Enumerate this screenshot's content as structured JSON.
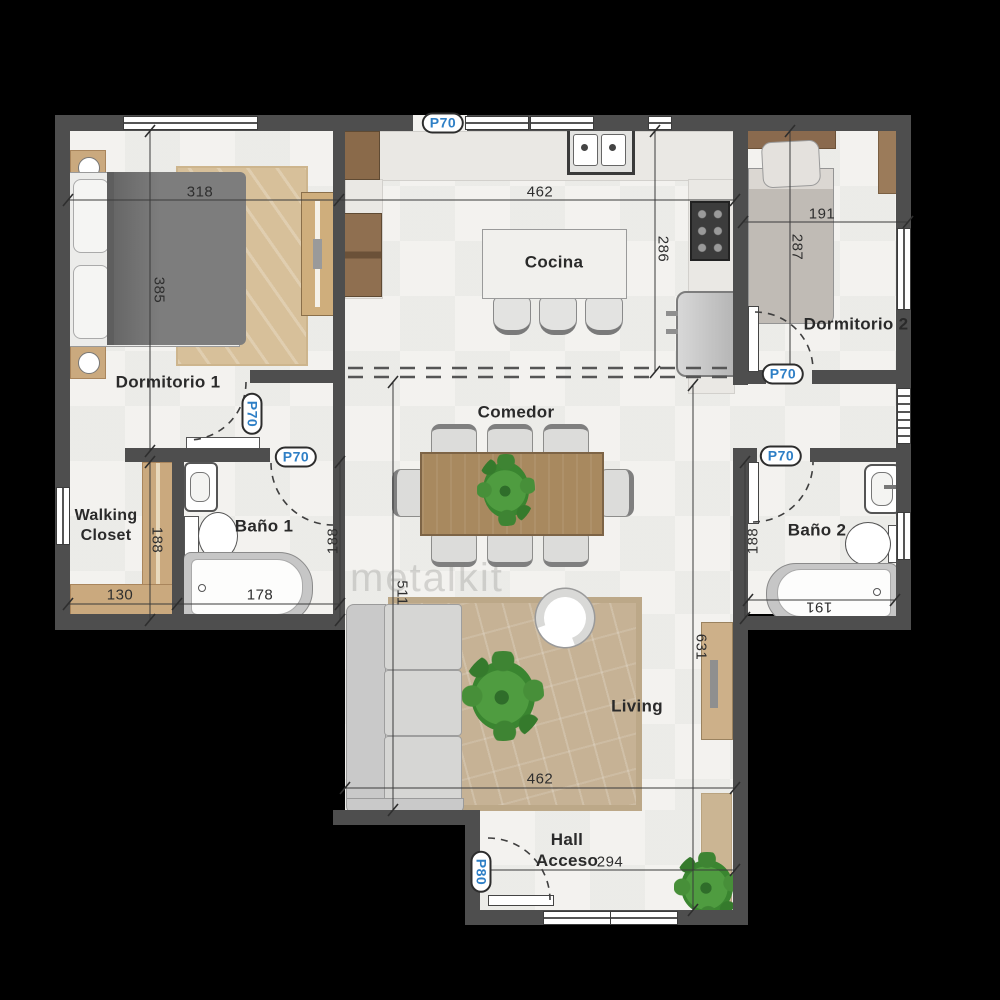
{
  "meta": {
    "watermark": "metalkit"
  },
  "colors": {
    "background": "#000000",
    "wall_gray": "#4e4e4e",
    "floor_white": "#f3f2ef",
    "door_label_blue": "#2e7fc6",
    "wood_tan": "#caa97e",
    "rug_tan": "#c6b295"
  },
  "rooms": {
    "dormitorio1": {
      "label": "Dormitorio 1"
    },
    "dormitorio2": {
      "label": "Dormitorio 2"
    },
    "cocina": {
      "label": "Cocina"
    },
    "comedor": {
      "label": "Comedor"
    },
    "living": {
      "label": "Living"
    },
    "bano1": {
      "label": "Baño 1"
    },
    "bano2": {
      "label": "Baño 2"
    },
    "walking_closet": {
      "label": "Walking\nCloset"
    },
    "hall": {
      "label": "Hall\nAcceso"
    }
  },
  "dimensions": {
    "dorm1_width": "318",
    "dorm1_depth": "385",
    "kitchen_width": "462",
    "kitchen_depth": "286",
    "dorm2_width": "191",
    "dorm2_depth": "287",
    "closet_width": "130",
    "closet_depth": "188",
    "bath1_tub": "178",
    "bath1_depth": "188",
    "bath2_depth": "188",
    "bath2_tub": "191",
    "living_depth": "511",
    "right_depth": "631",
    "living_width": "462",
    "hall_width": "294"
  },
  "doors": {
    "kitchen_balcony": "P70",
    "dormitorio1": "P70",
    "bano1": "P70",
    "dormitorio2": "P70",
    "bano2": "P70",
    "hall_entry": "P80"
  }
}
